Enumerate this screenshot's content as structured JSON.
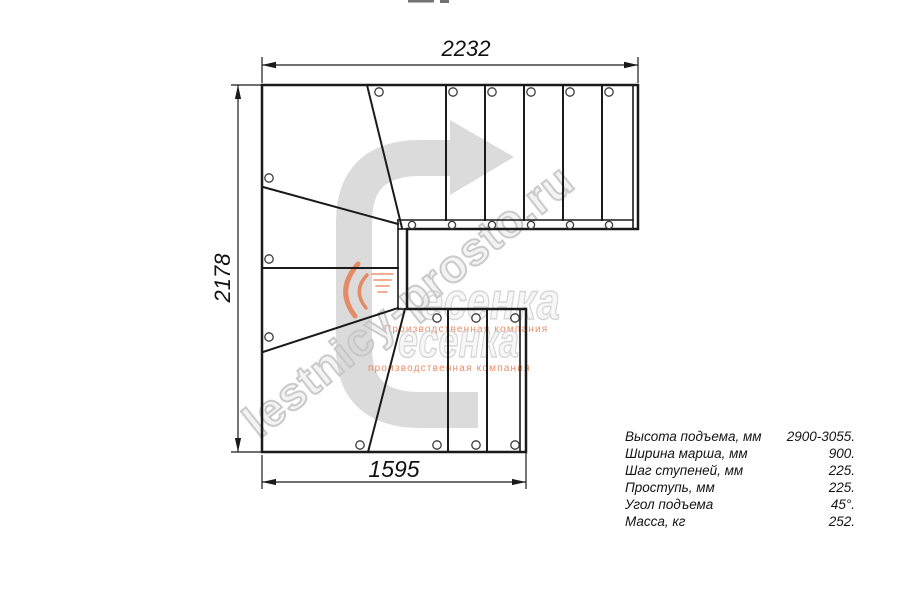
{
  "dimensions": {
    "top": "2232",
    "left": "2178",
    "bottom": "1595"
  },
  "specs": {
    "rows": [
      {
        "label": "Высота подъема, мм",
        "value": "2900-3055."
      },
      {
        "label": "Ширина марша, мм",
        "value": "900."
      },
      {
        "label": "Шаг ступеней, мм",
        "value": "225."
      },
      {
        "label": "Проступь, мм",
        "value": "225."
      },
      {
        "label": "Угол подъема",
        "value": "45°."
      },
      {
        "label": "Масса, кг",
        "value": "252."
      }
    ]
  },
  "watermark": {
    "site": "lestnicy-prosto.ru",
    "logo": "есенка",
    "tagline": "Производственная компания",
    "tagline2": "производственная компания"
  },
  "icons": {
    "direction_arrow": "u-turn-up-then-right-arrow",
    "logo_flame": "flame-swoosh-icon"
  },
  "colors": {
    "line": "#1a1a1a",
    "direction_arrow": "#dbdbdb",
    "watermark_outline": "#c6c6c6",
    "logo_orange": "#e8703f"
  }
}
